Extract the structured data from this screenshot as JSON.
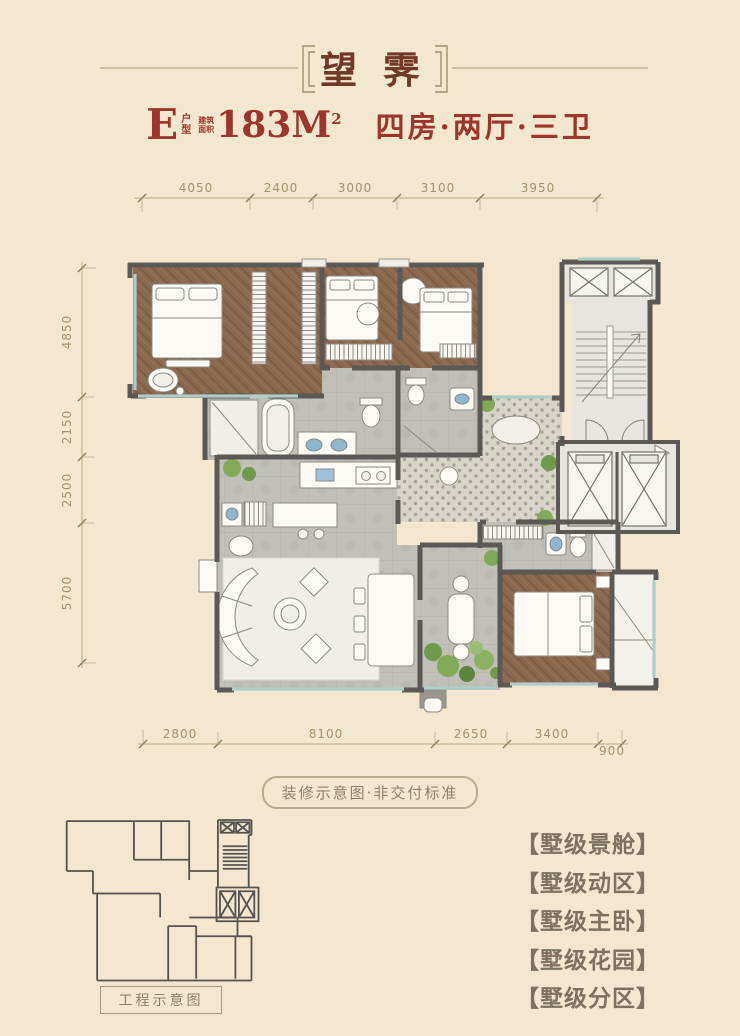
{
  "header": {
    "title": "望霁",
    "unit": "E",
    "unit_type_small": "户型",
    "area_label_small": "建筑面积",
    "area_value": "183M",
    "area_sup": "2",
    "layout": "四房·两厅·三卫"
  },
  "dimensions": {
    "top": [
      "4050",
      "2400",
      "3000",
      "3100",
      "3950"
    ],
    "left": [
      "4850",
      "2150",
      "2500",
      "5700"
    ],
    "bottom": [
      "2800",
      "8100",
      "2650",
      "3400",
      "900"
    ]
  },
  "note": "装修示意图·非交付标准",
  "mini_plan_label": "工程示意图",
  "features": [
    "【墅级景舱】",
    "【墅级动区】",
    "【墅级主卧】",
    "【墅级花园】",
    "【墅级分区】"
  ],
  "colors": {
    "background": "#f3e8cf",
    "title_text": "#6f3a28",
    "subtitle_text": "#9c352b",
    "dimension_text": "#a5926f",
    "feature_text": "#7b7262",
    "wall": "#5b5955",
    "wood_floor": "#8a6950",
    "tile_floor": "#c0bfb8",
    "window_glass": "#aecdc8",
    "plant_green": "#7fa957",
    "fixture_blue": "#8fb6cf"
  }
}
